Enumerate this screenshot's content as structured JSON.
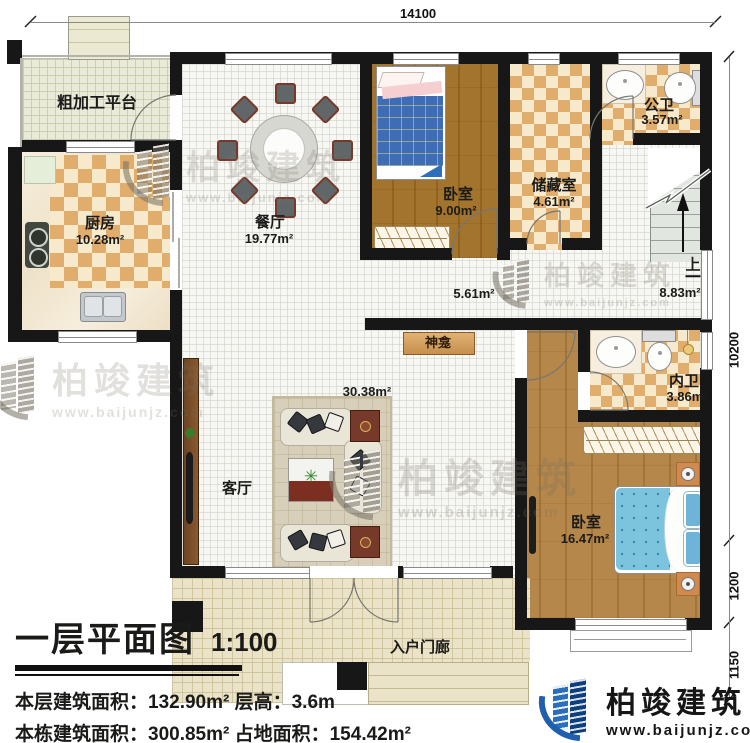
{
  "dimensions": {
    "top": "14100",
    "right_main": "10200",
    "right_mid": "1200",
    "right_bottom": "1150"
  },
  "rooms": {
    "platform": {
      "label": "粗加工平台"
    },
    "kitchen": {
      "label": "厨房",
      "area": "10.28m²"
    },
    "dining": {
      "label": "餐厅",
      "area": "19.77m²"
    },
    "bedroom1": {
      "label": "卧室",
      "area": "9.00m²"
    },
    "storage": {
      "label": "储藏室",
      "area": "4.61m²"
    },
    "public_bath": {
      "label": "公卫",
      "area": "3.57m²"
    },
    "hallway": {
      "area": "5.61m²"
    },
    "stair_hall": {
      "area": "8.83m²",
      "up": "上"
    },
    "shrine": {
      "label": "神龛"
    },
    "living": {
      "label": "客厅",
      "area": "30.38m²"
    },
    "inner_bath": {
      "label": "内卫",
      "area": "3.86m²"
    },
    "bedroom2": {
      "label": "卧室",
      "area": "16.47m²"
    },
    "porch": {
      "label": "入户门廊"
    }
  },
  "title_block": {
    "title": "一层平面图",
    "scale": "1:100",
    "line1": "本层建筑面积：132.90m²  层高：3.6m",
    "line2": "本栋建筑面积：300.85m²  占地面积：154.42m²"
  },
  "logo": {
    "name": "柏竣建筑",
    "url": "www.baijunjz.com"
  },
  "watermark": {
    "name": "柏竣建筑",
    "url": "www.baijunjz.com"
  },
  "colors": {
    "wall": "#171717",
    "checker_dark": "#e0ad6c",
    "checker_light": "#f7e9cb",
    "wood_bedroom1": "#a3742e",
    "wood_bedroom2": "#b5874a",
    "bed_plaid_blue": "#3f6db5",
    "bed_dot_blue": "#7cc4dd",
    "logo_blue": "#1f5fae"
  }
}
